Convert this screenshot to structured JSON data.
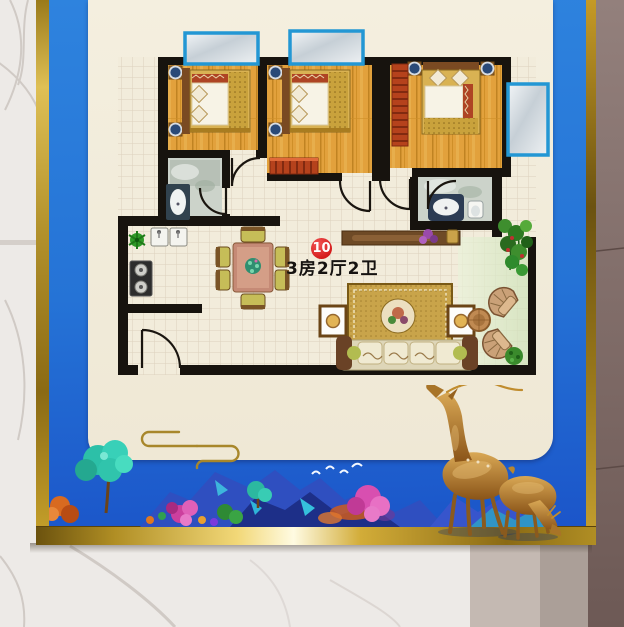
{
  "poster": {
    "badge": {
      "number": "10"
    },
    "caption": "3房2厅2卫",
    "colors": {
      "frame_gold": "#b9952c",
      "background_blue": "#2573d6",
      "panel_cream": "#f1ead8",
      "badge_red": "#d41c1c",
      "wall_black": "#17130e",
      "wood_floor": "#e2a13c",
      "balcony_frame_blue": "#2397d4"
    },
    "floor_plan": {
      "rooms": [
        "bedroom-1",
        "bedroom-2",
        "bedroom-3",
        "bathroom-1",
        "bathroom-2",
        "kitchen",
        "dining-area",
        "living-room",
        "balcony",
        "entry"
      ]
    },
    "art": {
      "elements": [
        "gold-cloud-motif",
        "mountain-landscape",
        "teal-tree",
        "pink-flower-tree",
        "white-birds",
        "golden-deer-standing",
        "golden-deer-grazing"
      ]
    }
  }
}
